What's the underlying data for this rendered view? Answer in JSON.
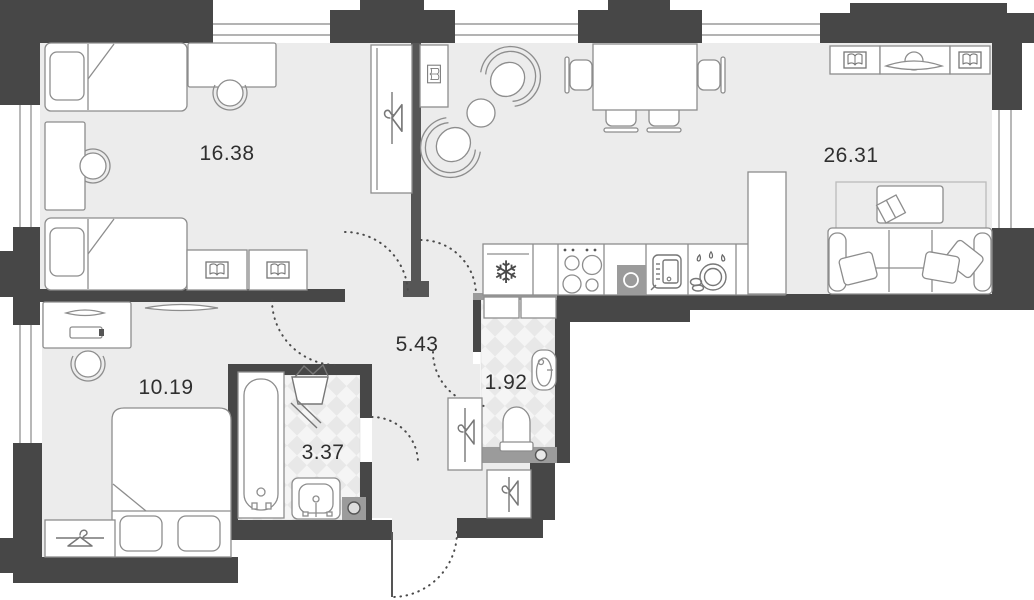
{
  "plan_title": "apartment floor plan",
  "rooms": [
    {
      "name": "bedroom-large",
      "area": "16.38"
    },
    {
      "name": "living-room-kitchen",
      "area": "26.31"
    },
    {
      "name": "hallway",
      "area": "5.43"
    },
    {
      "name": "toilet",
      "area": "1.92"
    },
    {
      "name": "bathroom",
      "area": "3.37"
    },
    {
      "name": "bedroom-small",
      "area": "10.19"
    }
  ],
  "colors": {
    "wall": "#474747",
    "wall_light": "#9b9b9b",
    "floor": "#ececec",
    "tile_light": "#f5f5f5",
    "tile_dark": "#e8e8e8",
    "furniture_line": "#8d8d8d",
    "label": "#2f2f2f"
  },
  "icons": [
    "snowflake-fridge-icon",
    "stove-burners-icon",
    "kitchen-sink-icon",
    "oven-icon",
    "dishes-icon",
    "hanger-icon",
    "open-book-icon",
    "tv-icon",
    "laundry-basket-icon",
    "bathtub-icon",
    "toilet-icon",
    "washbasin-icon",
    "washing-machine-icon",
    "sofa-icon",
    "armchair-icon",
    "bed-icon",
    "desk-chair-icon",
    "dining-set-icon",
    "door-swing-arc",
    "window-glazing"
  ]
}
